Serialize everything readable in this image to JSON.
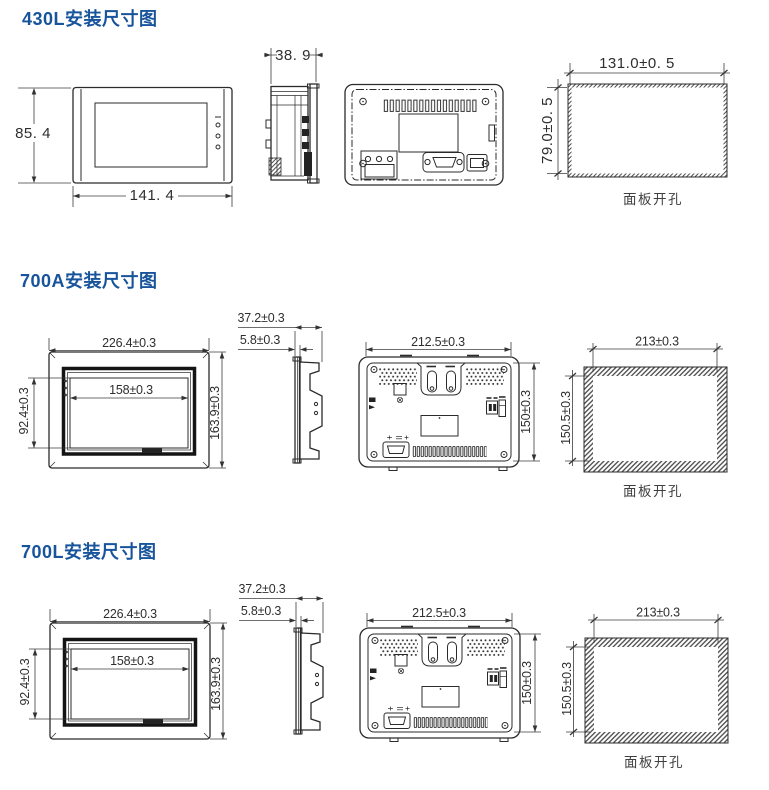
{
  "doc": {
    "type": "installation-dimension-diagram",
    "unit_style": "mm"
  },
  "colors": {
    "title_blue": "#17549b",
    "line_dark": "#2b2b2b",
    "dim_text": "#2e2e2e"
  },
  "sections": [
    {
      "model": "430L",
      "title": "430L安装尺寸图",
      "front": {
        "height": "85. 4",
        "width": "141. 4"
      },
      "side": {
        "depth": "38. 9"
      },
      "cutout": {
        "width": "131.0±0. 5",
        "height": "79.0±0. 5",
        "caption": "面板开孔"
      }
    },
    {
      "model": "700A",
      "title": "700A安装尺寸图",
      "front": {
        "width": "226.4±0.3",
        "height": "163.9±0.3",
        "screen_width": "158±0.3",
        "screen_height": "92.4±0.3"
      },
      "side": {
        "depth": "37.2±0.3",
        "bezel": "5.8±0.3"
      },
      "back": {
        "width": "212.5±0.3",
        "height": "150±0.3"
      },
      "cutout": {
        "width": "213±0.3",
        "height": "150.5±0.3",
        "caption": "面板开孔"
      }
    },
    {
      "model": "700L",
      "title": "700L安装尺寸图",
      "front": {
        "width": "226.4±0.3",
        "height": "163.9±0.3",
        "screen_width": "158±0.3",
        "screen_height": "92.4±0.3"
      },
      "side": {
        "depth": "37.2±0.3",
        "bezel": "5.8±0.3"
      },
      "back": {
        "width": "212.5±0.3",
        "height": "150±0.3"
      },
      "cutout": {
        "width": "213±0.3",
        "height": "150.5±0.3",
        "caption": "面板开孔"
      }
    }
  ]
}
